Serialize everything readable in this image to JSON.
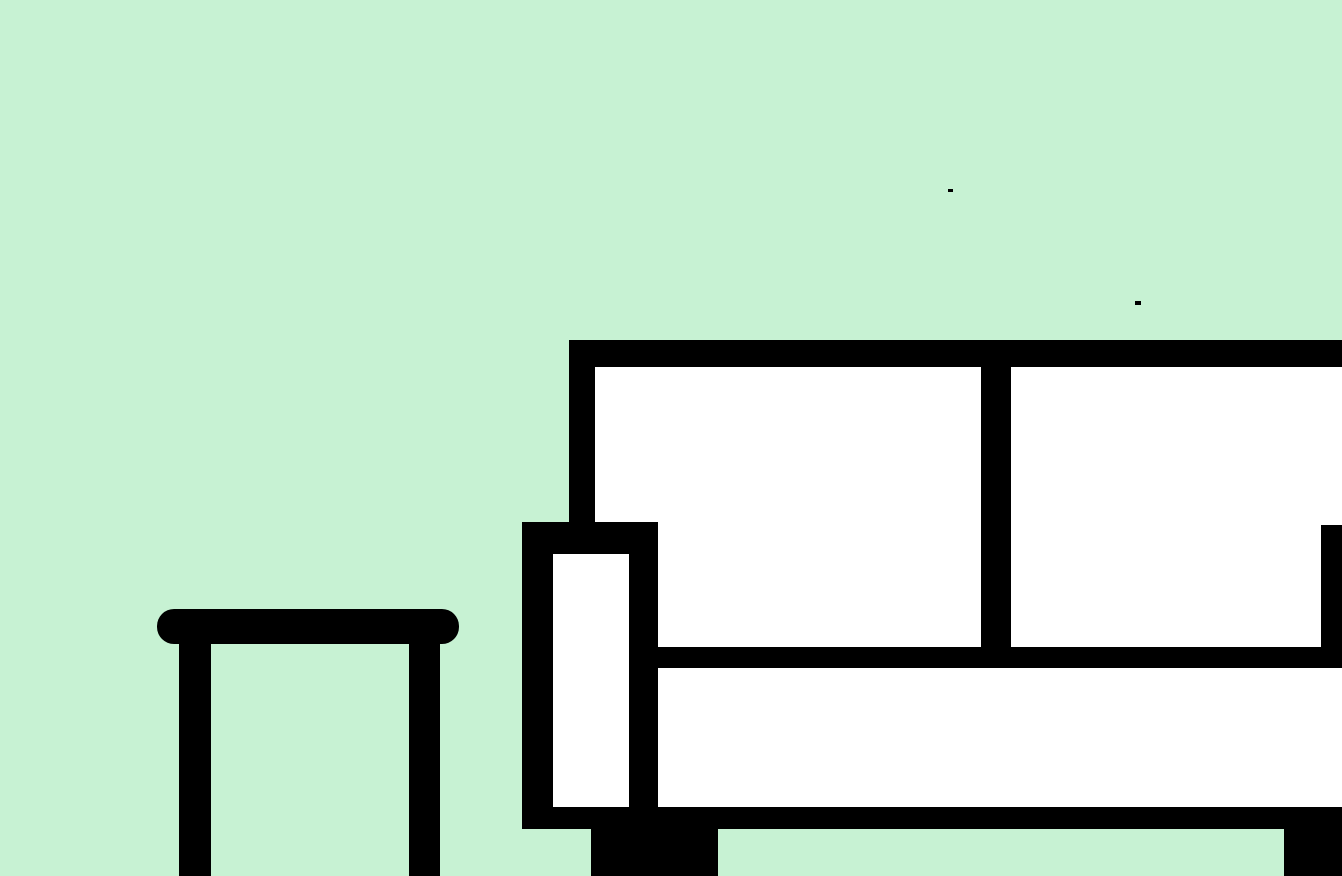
{
  "canvas": {
    "width": 1342,
    "height": 876,
    "background_color": "#c7f2d3"
  },
  "palette": {
    "background": "#c7f2d3",
    "outline": "#000000",
    "fill": "#ffffff"
  },
  "scene": {
    "description": "Flat cartoon living-room illustration: a white sofa with thick black outline on the right (cut off by the right edge) and a black round-top side table on the left, both on a plain mint-green background; two tiny stray black specks float in the upper area.",
    "objects": {
      "sofa": "white sofa with black outline, two back cushions, left armrest, base and legs",
      "side_table": "black side table with oval top and two straight legs, cut off at bottom edge",
      "specks": "two small stray black marks"
    },
    "shapes": [
      {
        "name": "sofa-back-frame",
        "type": "rect",
        "x": 569,
        "y": 340,
        "w": 773,
        "h": 328,
        "color": "#000000"
      },
      {
        "name": "sofa-back-cushion-left",
        "type": "rect",
        "x": 595,
        "y": 367,
        "w": 386,
        "h": 280,
        "color": "#ffffff"
      },
      {
        "name": "sofa-back-cushion-right",
        "type": "rect",
        "x": 1011,
        "y": 367,
        "w": 331,
        "h": 280,
        "color": "#ffffff"
      },
      {
        "name": "sofa-armrest-right",
        "type": "rect",
        "x": 1321,
        "y": 525,
        "w": 21,
        "h": 143,
        "color": "#000000"
      },
      {
        "name": "sofa-seat",
        "type": "rect",
        "x": 657,
        "y": 668,
        "w": 685,
        "h": 139,
        "color": "#ffffff"
      },
      {
        "name": "sofa-armrest-left",
        "type": "rect",
        "x": 522,
        "y": 522,
        "w": 136,
        "h": 307,
        "color": "#000000"
      },
      {
        "name": "sofa-armrest-left-inner",
        "type": "rect",
        "x": 553,
        "y": 554,
        "w": 76,
        "h": 253,
        "color": "#ffffff"
      },
      {
        "name": "sofa-base-rail",
        "type": "rect",
        "x": 522,
        "y": 807,
        "w": 820,
        "h": 22,
        "color": "#000000"
      },
      {
        "name": "sofa-front-leg",
        "type": "rect",
        "x": 591,
        "y": 829,
        "w": 127,
        "h": 47,
        "color": "#000000"
      },
      {
        "name": "sofa-right-leg",
        "type": "rect",
        "x": 1284,
        "y": 829,
        "w": 58,
        "h": 47,
        "color": "#000000"
      },
      {
        "name": "table-top",
        "type": "stadium",
        "x": 157,
        "y": 609,
        "w": 302,
        "h": 35,
        "color": "#000000",
        "radius": 17
      },
      {
        "name": "table-left-leg",
        "type": "rect",
        "x": 179,
        "y": 640,
        "w": 32,
        "h": 236,
        "color": "#000000"
      },
      {
        "name": "table-right-leg",
        "type": "rect",
        "x": 409,
        "y": 640,
        "w": 31,
        "h": 236,
        "color": "#000000"
      },
      {
        "name": "paint-speck-1",
        "type": "rect",
        "x": 948,
        "y": 189,
        "w": 5,
        "h": 3,
        "color": "#000000"
      },
      {
        "name": "paint-speck-2",
        "type": "rect",
        "x": 1135,
        "y": 301,
        "w": 6,
        "h": 4,
        "color": "#000000"
      }
    ]
  }
}
